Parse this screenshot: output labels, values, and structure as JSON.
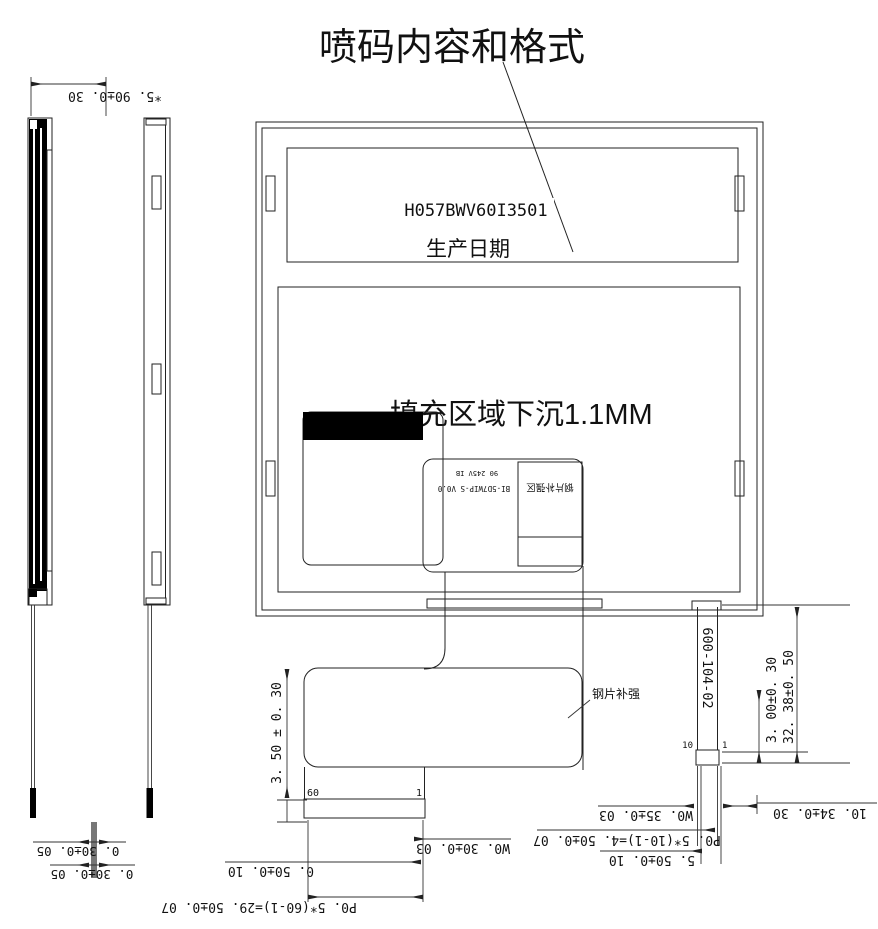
{
  "title": "喷码内容和格式",
  "front_view": {
    "label_band": {
      "part_number": "H057BWV60I3501",
      "date_label": "生产日期"
    },
    "fill_note": "填充区域下沉1.1MM",
    "fpc_marking_line1": "90 245V IB",
    "fpc_marking_line2": "BI-5D7WIP-S V0.0",
    "stiffener_zone_label": "钢片补强区"
  },
  "bottom_fpc": {
    "steel_label": "钢片补强",
    "pin_first": "60",
    "pin_last": "1"
  },
  "right_fpc": {
    "part_number": "600-104-02",
    "pin_first": "10",
    "pin_last": "1"
  },
  "dimensions": {
    "top_left": "*5. 90±0. 30",
    "left_vertical": "3. 50 ± 0. 30",
    "right_vertical_inner": "3. 00±0. 30",
    "right_vertical_outer": "32. 38±0. 50",
    "bottom_left_thickness_1": "0. 30±0. 05",
    "bottom_left_thickness_2": "0. 30±0. 05",
    "bottom_width": "W0. 30±0. 03",
    "bottom_margin": "0. 50±0. 10",
    "bottom_pitch": "P0. 5*(60-1)=29. 50±0. 07",
    "bottom_right_width": "W0. 35±0. 03",
    "bottom_right_pitch": "P0. 5*(10-1)=4. 50±0. 07",
    "bottom_right_margin": "5. 50±0. 10",
    "bottom_right_offset": "10. 34±0. 30"
  },
  "colors": {
    "line": "#222222",
    "black_fill": "#000000",
    "paper": "#ffffff"
  }
}
